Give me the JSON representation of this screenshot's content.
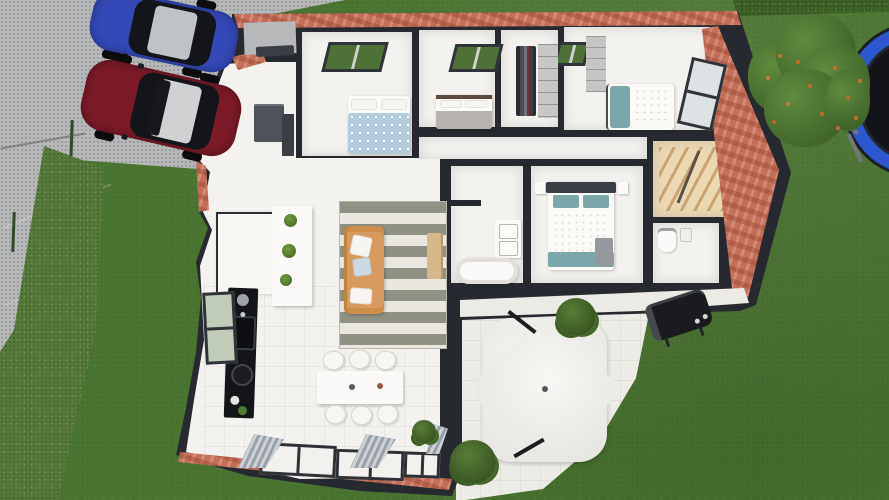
{
  "scene": {
    "title": "3D floor plan render of a single-storey house with garden, driveway and patio",
    "view": "top-down 3D dollhouse view"
  },
  "colors": {
    "grass": "#4a7530",
    "hedge": "#567a3a",
    "hedge_row": "#3e6327",
    "driveway": "#b7b8ba",
    "wall": "#26292f",
    "brick": "#c3705a",
    "floor": "#f4f2ee",
    "patio": "#edebe5",
    "stairs": "#ecd9b4",
    "counter": "#141518",
    "sofa": "#d89a5e",
    "wood": "#d8b88b",
    "teal": "#7ca7aa",
    "duvet_blue": "#b3cddd",
    "duvet_gray": "#b7b4af",
    "umbrella": "#f2f1ed",
    "trampoline": "#2b58cf",
    "car_blue": "#3449b8",
    "car_red": "#7c1a28",
    "tree": "#4a6e2e",
    "grill": "#1a1b1e"
  },
  "outdoor": {
    "driveway_label": "paved driveway with two parked cars",
    "vehicles": [
      {
        "label": "blue hatchback car",
        "color": "#3449b8"
      },
      {
        "label": "dark red car",
        "color": "#7c1a28"
      }
    ],
    "garden": [
      {
        "label": "fruit tree with orange fruits"
      },
      {
        "label": "blue trampoline"
      },
      {
        "label": "black barbecue grill"
      },
      {
        "label": "garden hedge"
      },
      {
        "label": "wire fence"
      },
      {
        "label": "street-side hedge row"
      }
    ],
    "patio": {
      "label": "white patio terrace",
      "items": [
        "white patio umbrella",
        "shrub",
        "shrub"
      ]
    }
  },
  "house": {
    "walls_label": "dark cut wall tops with brick outer facade",
    "rooms": [
      {
        "id": "entry",
        "label": "entry hall",
        "furniture": [
          "front door",
          "tall grey cabinet"
        ]
      },
      {
        "id": "bedroom-1",
        "label": "bedroom 1",
        "furniture": [
          "double bed with blue patterned duvet",
          "window"
        ]
      },
      {
        "id": "bedroom-2",
        "label": "bedroom 2",
        "furniture": [
          "bed with grey duvet",
          "window"
        ]
      },
      {
        "id": "closet",
        "label": "walk-in wardrobe",
        "furniture": [
          "hanging clothes",
          "shelving"
        ]
      },
      {
        "id": "bedroom-3",
        "label": "bedroom 3",
        "furniture": [
          "bed with teal bolster",
          "shelf unit",
          "side window"
        ]
      },
      {
        "id": "hallway",
        "label": "hallway",
        "furniture": []
      },
      {
        "id": "master-bedroom",
        "label": "master bedroom",
        "furniture": [
          "double bed with teal pillows",
          "bedside tables"
        ]
      },
      {
        "id": "bathroom",
        "label": "bathroom",
        "furniture": [
          "bathtub",
          "double vanity"
        ]
      },
      {
        "id": "staircase",
        "label": "wooden staircase",
        "furniture": []
      },
      {
        "id": "wc",
        "label": "toilet room",
        "furniture": [
          "toilet"
        ]
      },
      {
        "id": "living-room",
        "label": "living room",
        "furniture": [
          "orange sofa",
          "striped rug",
          "wooden sideboard"
        ]
      },
      {
        "id": "kitchen",
        "label": "kitchen",
        "furniture": [
          "black worktop with sink and hob",
          "island with plants",
          "window",
          "white storage unit"
        ]
      },
      {
        "id": "dining",
        "label": "dining area",
        "furniture": [
          "white dining table",
          "six chairs",
          "glazed doors with curtains",
          "potted plant"
        ]
      }
    ]
  }
}
